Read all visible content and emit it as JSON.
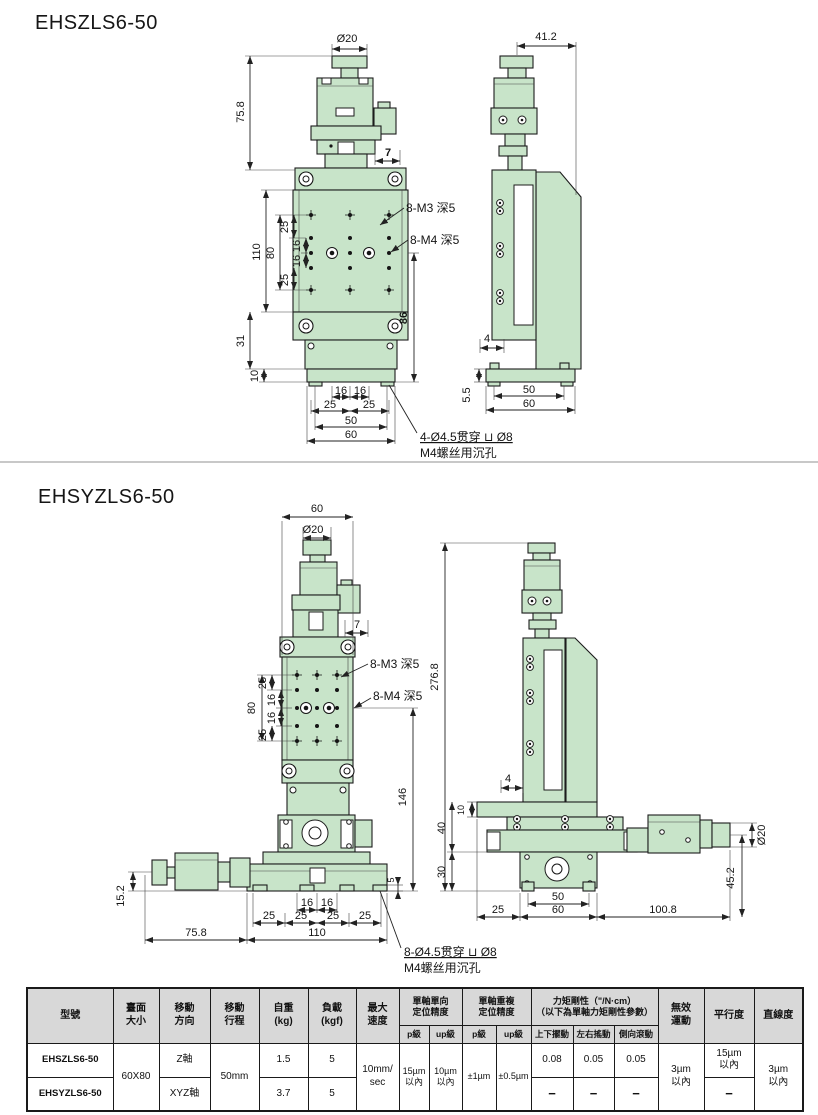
{
  "section1": {
    "title": "EHSZLS6-50"
  },
  "section2": {
    "title": "EHSYZLS6-50"
  },
  "dims": {
    "d20": "Ø20",
    "v758": "75.8",
    "v7": "7",
    "v110": "110",
    "v80": "80",
    "v25": "25",
    "v16": "16",
    "v31": "31",
    "v10": "10",
    "v86": "86",
    "v50": "50",
    "v60": "60",
    "v412": "41.2",
    "v4": "4",
    "v55": "5.5",
    "v152": "15.2",
    "v146": "146",
    "v2768": "276.8",
    "v40": "40",
    "v30": "30",
    "v5": "5",
    "v1008": "100.8",
    "v452": "45.2",
    "m3": "8-M3 深5",
    "m4": "8-M4 深5",
    "note1a": "4-Ø4.5贯穿 ⊔ Ø8",
    "note2a": "8-Ø4.5贯穿 ⊔ Ø8",
    "noteb": "M4螺丝用沉孔"
  },
  "table": {
    "h_model": "型號",
    "h_size": "臺面\n大小",
    "h_dir": "移動\n方向",
    "h_travel": "移動\n行程",
    "h_weight": "自重\n(kg)",
    "h_load": "負載\n(kgf)",
    "h_speed": "最大\n速度",
    "h_uni": "單軸單向\n定位精度",
    "h_rep": "單軸重複\n定位精度",
    "h_tq": "力矩剛性（\"/N·cm）\n（以下為單軸力矩剛性參數）",
    "h_p": "p級",
    "h_up": "up級",
    "h_c1": "上下擺動",
    "h_c2": "左右搖動",
    "h_c3": "側向滾動",
    "h_lost": "無效\n運動",
    "h_par": "平行度",
    "h_lin": "直線度",
    "rows": [
      {
        "model": "EHSZLS6-50",
        "size": "60X80",
        "dir": "Z軸",
        "travel": "50mm",
        "weight": "1.5",
        "load": "5",
        "speed": "10mm/\nsec",
        "uni_p": "15µm\n以內",
        "uni_up": "10µm\n以內",
        "rep_p": "±1µm",
        "rep_up": "±0.5µm",
        "c1": "0.08",
        "c2": "0.05",
        "c3": "0.05",
        "lost": "3µm\n以內",
        "par": "15µm\n以內",
        "lin": "3µm\n以內"
      },
      {
        "model": "EHSYZLS6-50",
        "dir": "XYZ軸",
        "weight": "3.7",
        "load": "5",
        "c1": "−",
        "c2": "−",
        "c3": "−",
        "par": "−"
      }
    ]
  }
}
